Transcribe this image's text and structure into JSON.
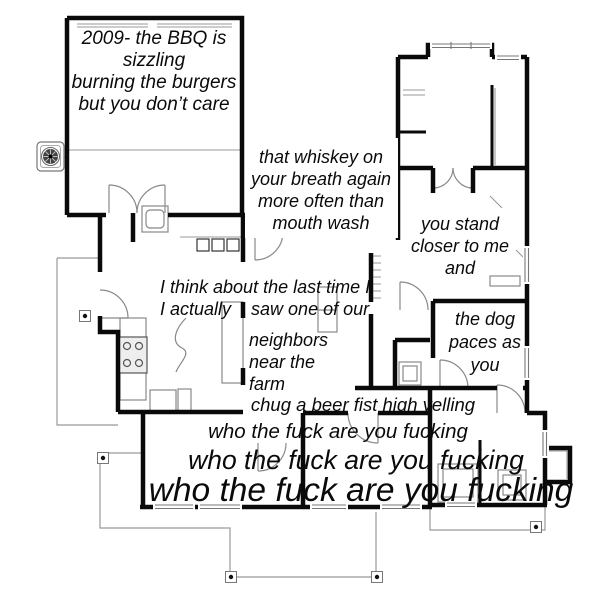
{
  "meta": {
    "kind": "floor-plan lyric meme",
    "background_color": "#ffffff",
    "wall_color": "#0a0a0a",
    "thin_line_color": "#999999",
    "text_color": "#0a0a0a",
    "icons": [
      "ceiling-fan-icon",
      "porch-post-icon",
      "stove-icon",
      "sink-icon",
      "shower-icon",
      "door-arc-icon",
      "window-icon"
    ]
  },
  "lyrics": {
    "garage": {
      "lines": [
        "2009- the BBQ is",
        "sizzling",
        "burning the burgers",
        "but you don’t care"
      ]
    },
    "whiskey": {
      "lines": [
        "that whiskey on",
        "your breath again",
        "more often than",
        "mouth wash"
      ]
    },
    "you_stand": {
      "lines": [
        "you stand",
        "closer to me",
        "and"
      ]
    },
    "last_time": {
      "lines": [
        "I think about the last time I",
        "I actually    saw one of our"
      ]
    },
    "neighbors": {
      "lines": [
        "neighbors",
        "near the",
        "farm"
      ]
    },
    "dog": {
      "lines": [
        "the dog",
        "paces as",
        "you"
      ]
    },
    "chug": {
      "text": "chug a beer fist high yelling"
    },
    "who_small": {
      "text": "who the fuck are you fucking"
    },
    "who_medium": {
      "text": "who the fuck are you fucking"
    },
    "who_large": {
      "text": "who the fuck are you fucking"
    }
  }
}
